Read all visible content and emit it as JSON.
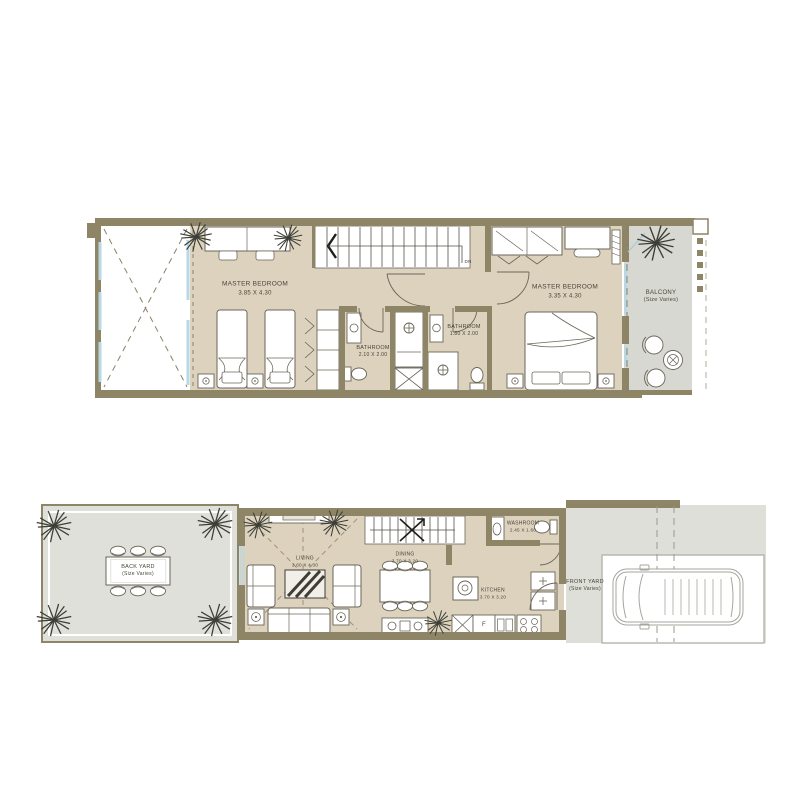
{
  "colors": {
    "wall": "#8e8466",
    "floor": "#dcd2be",
    "outdoor": "#dfe0da",
    "balcony": "#d8d8d2",
    "glass": "#b9d8e4",
    "ink": "#4a4539",
    "furniture_line": "#6b6659"
  },
  "upper_floor": {
    "master_bedroom_left": {
      "name": "MASTER BEDROOM",
      "dims": "3.85 X 4.30"
    },
    "master_bedroom_right": {
      "name": "MASTER BEDROOM",
      "dims": "3.35 X 4.30"
    },
    "bathroom_left": {
      "name": "BATHROOM",
      "dims": "2.10 X 2.00"
    },
    "bathroom_right": {
      "name": "BATHROOM",
      "dims": "1.80 X 2.00"
    },
    "balcony": {
      "name": "BALCONY",
      "dims": "(Size Varies)"
    },
    "stairs_label": "DN"
  },
  "ground_floor": {
    "back_yard": {
      "name": "BACK YARD",
      "dims": "(Size Varies)"
    },
    "living": {
      "name": "LIVING",
      "dims": "3.60 X 4.30"
    },
    "dining": {
      "name": "DINING",
      "dims": "3.70 X 3.20"
    },
    "washroom": {
      "name": "WASHROOM",
      "dims": "2.45 X 1.60"
    },
    "kitchen": {
      "name": "KITCHEN",
      "dims": "3.70 X 3.20"
    },
    "front_yard": {
      "name": "FRONT YARD",
      "dims": "(Size Varies)"
    },
    "fridge_label": "F"
  }
}
